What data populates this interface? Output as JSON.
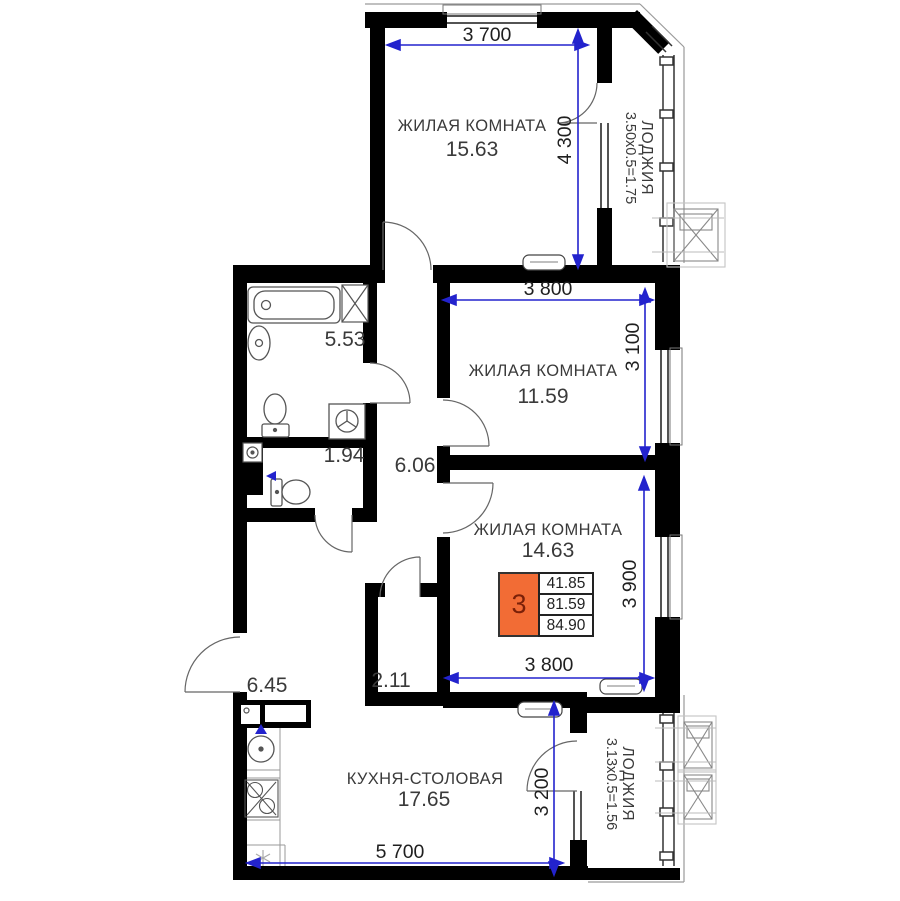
{
  "plan": {
    "rooms": [
      {
        "id": "living-1",
        "name": "ЖИЛАЯ КОМНАТА",
        "area": "15.63",
        "width_mm": "3 700",
        "height_mm": "4 300"
      },
      {
        "id": "living-2",
        "name": "ЖИЛАЯ КОМНАТА",
        "area": "11.59",
        "width_mm": "3 800",
        "height_mm": "3 100"
      },
      {
        "id": "living-3",
        "name": "ЖИЛАЯ КОМНАТА",
        "area": "14.63",
        "width_mm": "3 800",
        "height_mm": "3 900"
      },
      {
        "id": "kitchen-dining",
        "name": "КУХНЯ-СТОЛОВАЯ",
        "area": "17.65",
        "width_mm": "5 700",
        "height_mm": "3 200"
      }
    ],
    "utility_spaces": [
      {
        "id": "bathroom",
        "area": "5.53"
      },
      {
        "id": "wc",
        "area": "1.94"
      },
      {
        "id": "corridor",
        "area": "6.06"
      },
      {
        "id": "hall",
        "area": "6.45"
      },
      {
        "id": "wardrobe",
        "area": "2.11"
      }
    ],
    "loggias": [
      {
        "id": "loggia-top",
        "name": "ЛОДЖИЯ",
        "calc": "3.50х0.5=1.75"
      },
      {
        "id": "loggia-bottom",
        "name": "ЛОДЖИЯ",
        "calc": "3.13х0.5=1.56"
      }
    ],
    "badge": {
      "rooms_count": "3",
      "values": [
        "41.85",
        "81.59",
        "84.90"
      ]
    },
    "colors": {
      "badge_orange": "#f26c35",
      "badge_digit": "#7a2008",
      "dimension_blue": "#2323cd",
      "wall": "#000000"
    }
  }
}
